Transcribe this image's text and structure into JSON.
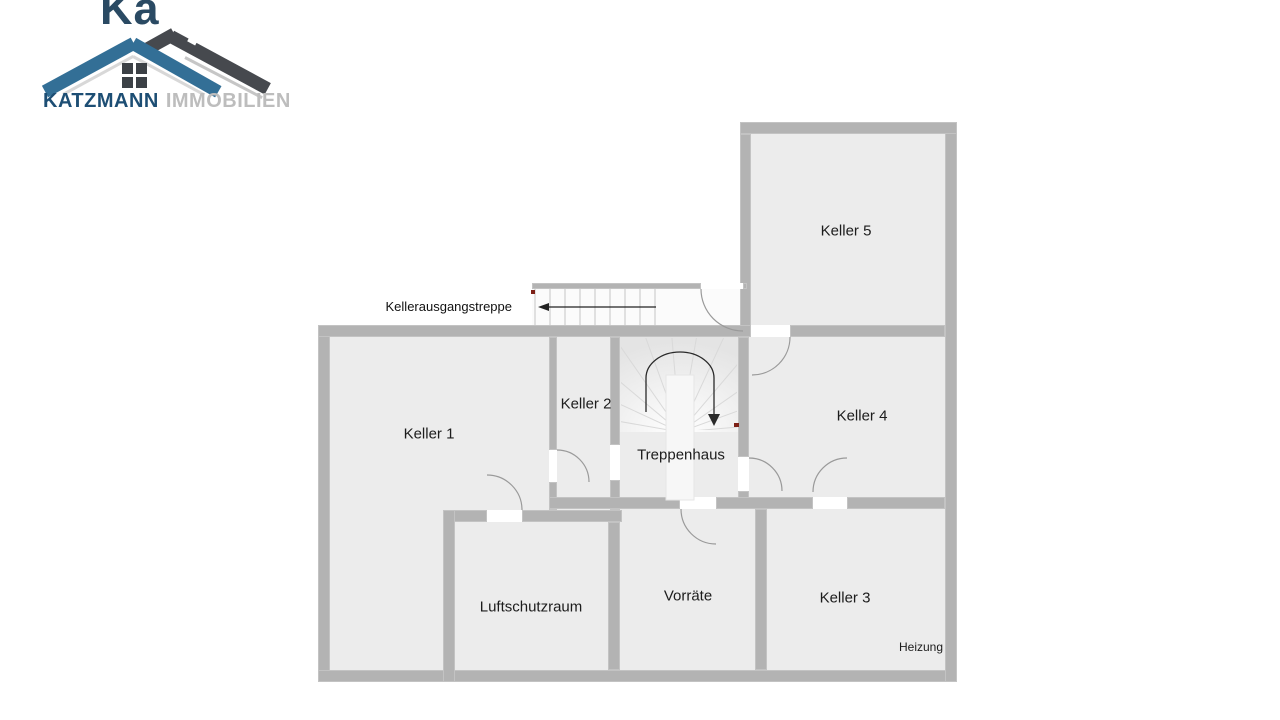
{
  "logo": {
    "watermark_fragment": "Ka",
    "brand": "KATZMANN",
    "brand_suffix": "IMMOBILIEN",
    "colors": {
      "roof_blue": "#336f96",
      "roof_dark": "#46494e",
      "brand_blue": "#1d4e74",
      "suffix_gray": "#bdbdbd"
    }
  },
  "floorplan": {
    "rooms": [
      {
        "id": "keller-5",
        "label": "Keller 5"
      },
      {
        "id": "keller-1",
        "label": "Keller 1"
      },
      {
        "id": "keller-2",
        "label": "Keller 2"
      },
      {
        "id": "treppenhaus",
        "label": "Treppenhaus"
      },
      {
        "id": "keller-4",
        "label": "Keller 4"
      },
      {
        "id": "luftschutzraum",
        "label": "Luftschutzraum"
      },
      {
        "id": "vorraete",
        "label": "Vorräte"
      },
      {
        "id": "keller-3",
        "label": "Keller 3"
      }
    ],
    "labels": {
      "heizung": "Heizung",
      "exit_stairs": "Kellerausgangstreppe"
    },
    "colors": {
      "wall": "#b3b3b3",
      "room_fill": "#ececec",
      "door_arc": "#9a9a9a",
      "marker_red": "#7d2016",
      "stair_tread": "#d6d6d6"
    }
  }
}
